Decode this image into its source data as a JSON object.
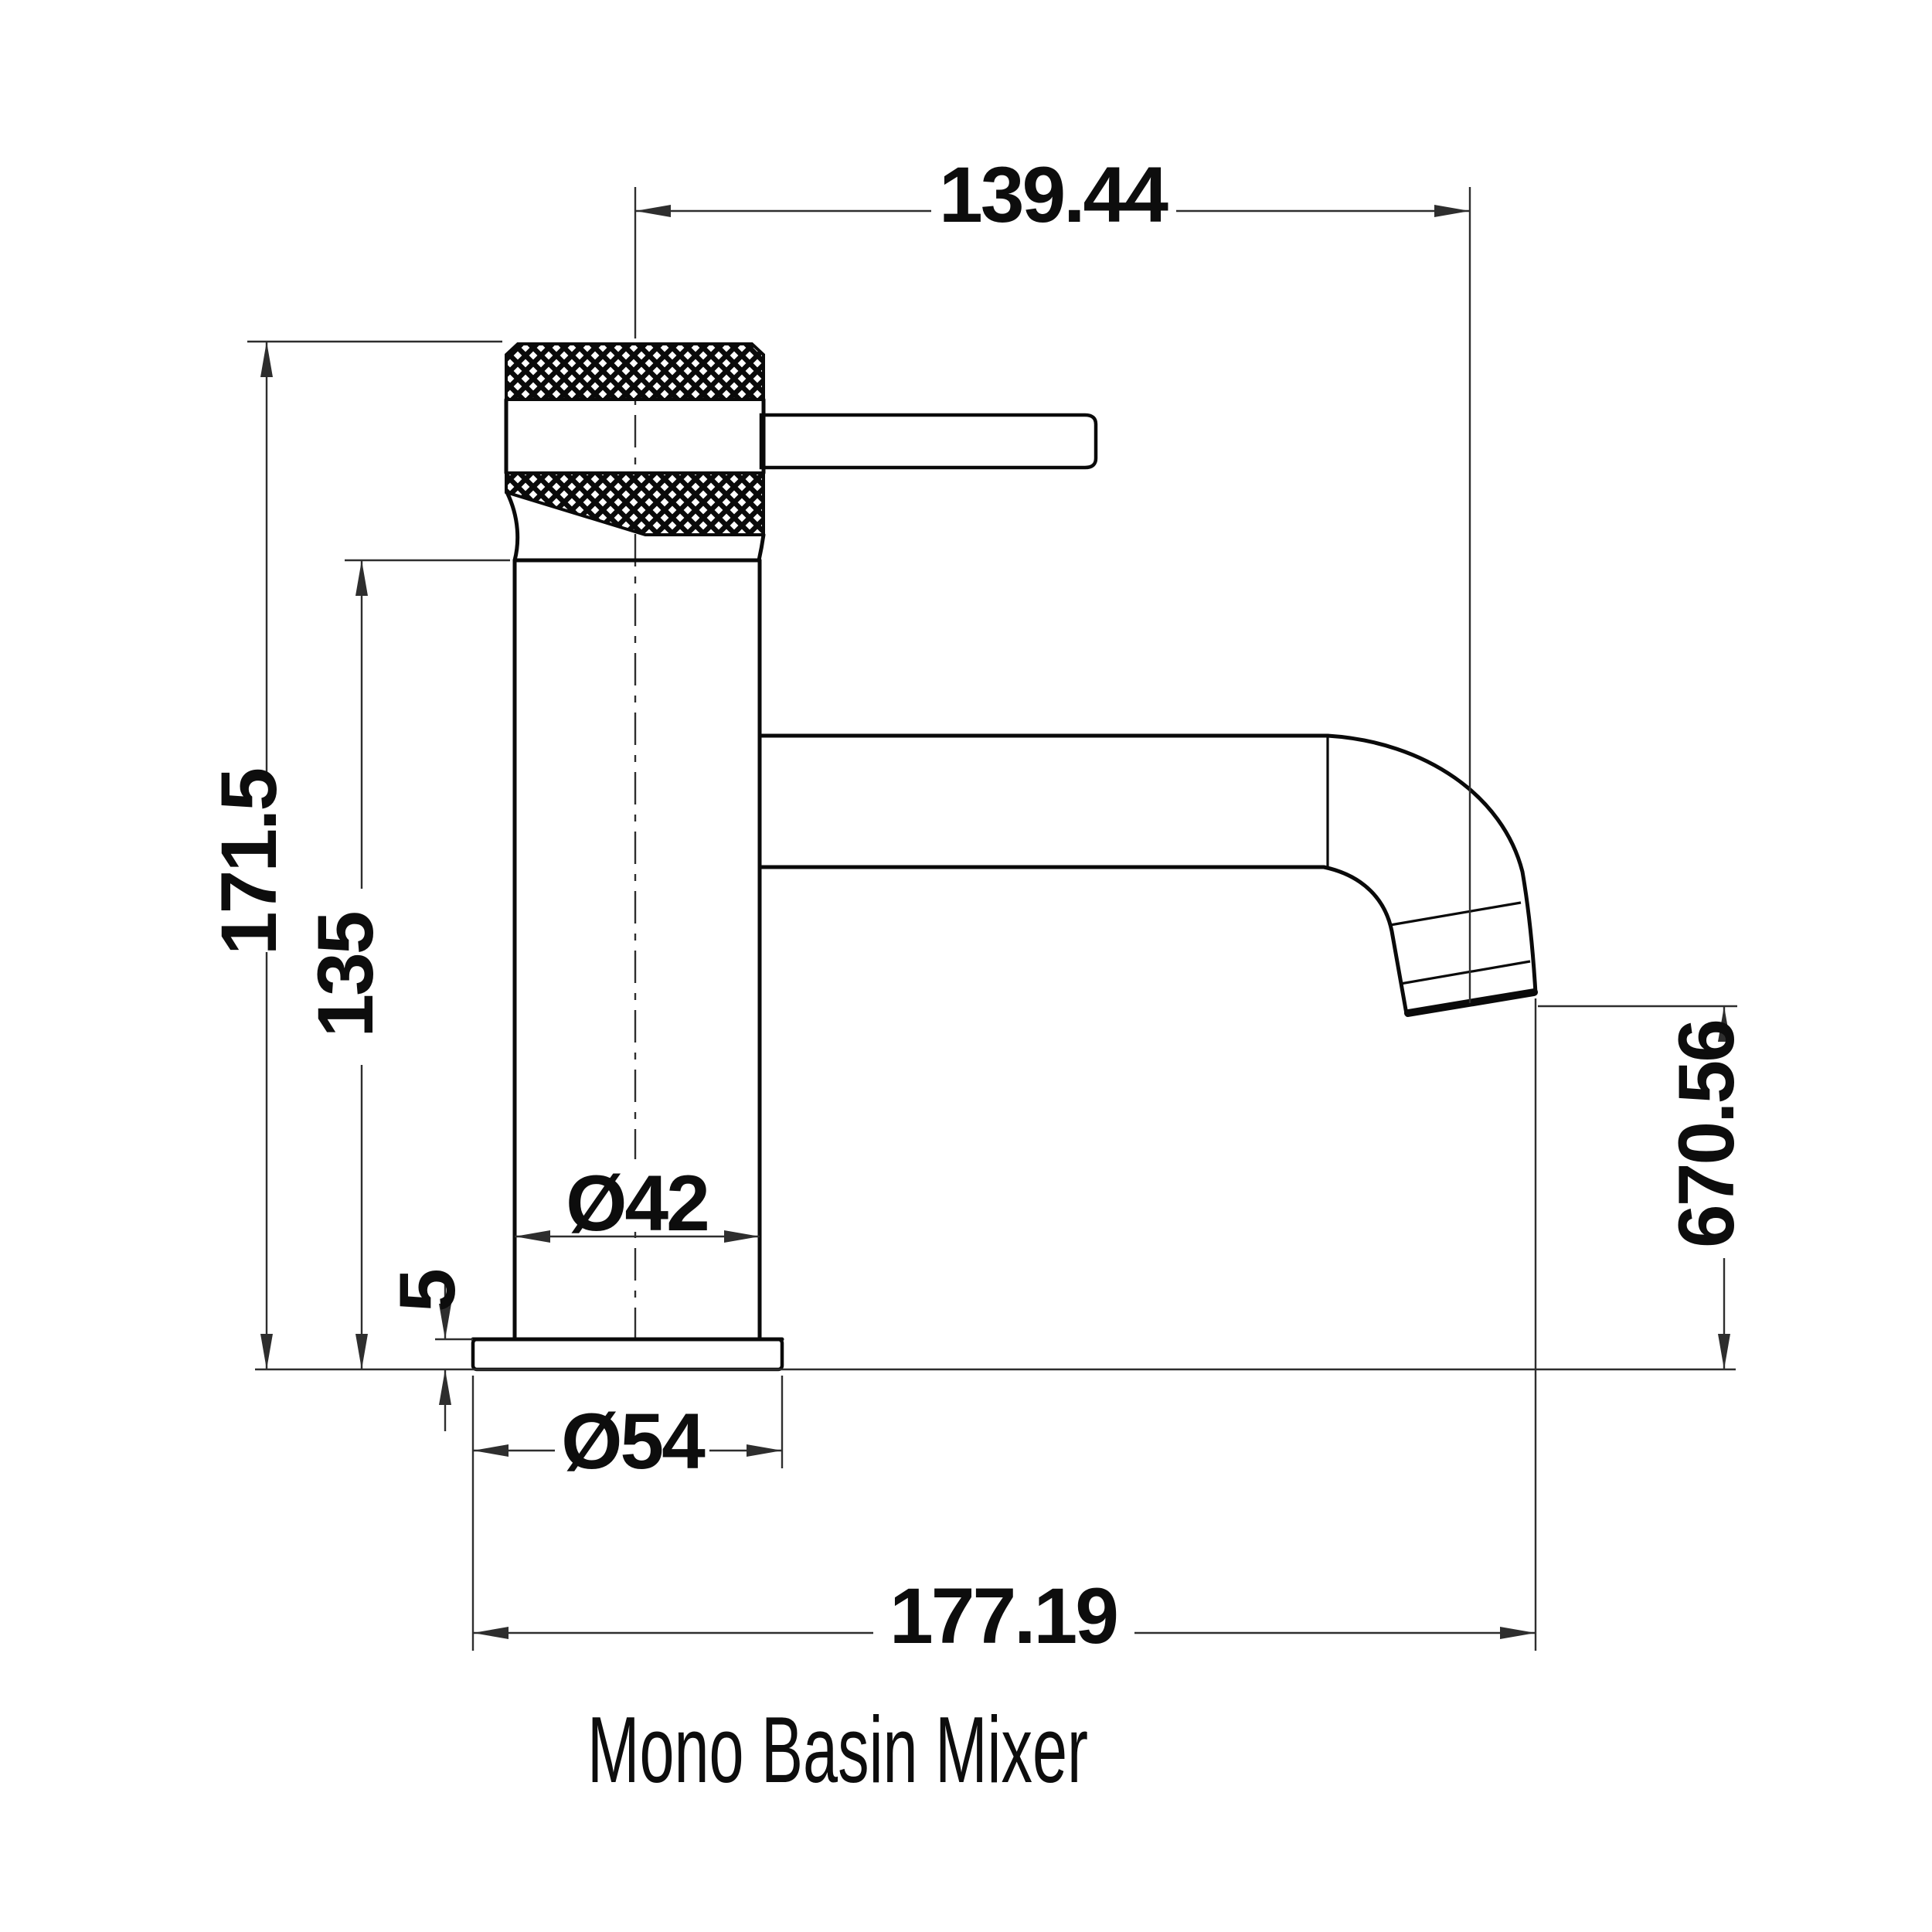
{
  "drawing": {
    "title": "Mono Basin Mixer",
    "dims": {
      "spout_reach": "139.44",
      "overall_height": "171.5",
      "body_height": "135",
      "body_diameter": "Ø42",
      "base_thickness": "5",
      "base_diameter": "Ø54",
      "outlet_height": "670.56",
      "overall_depth": "177.19"
    },
    "colors": {
      "background": "#ffffff",
      "outline": "#0a0a0a",
      "dimension": "#2e2e2e",
      "text": "#0d0d0d"
    }
  }
}
